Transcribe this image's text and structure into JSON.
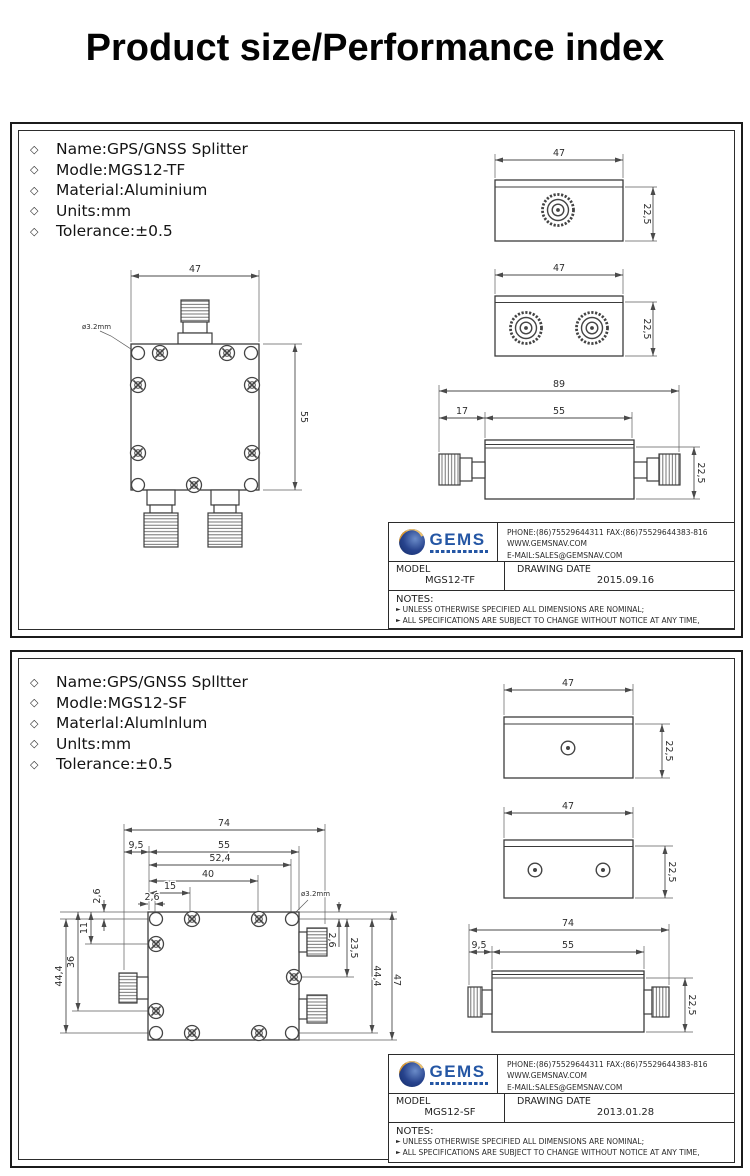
{
  "page_title": "Product size/Performance index",
  "panels": [
    {
      "specs": {
        "bullet": "◇",
        "items": [
          "Name:GPS/GNSS Splitter",
          "Modle:MGS12-TF",
          "Material:Aluminium",
          "Units:mm",
          "Tolerance:±0.5"
        ]
      },
      "front_view": {
        "width": "47",
        "height": "55",
        "hole": "ø3.2mm"
      },
      "top_view_1": {
        "width": "47",
        "height": "22,5"
      },
      "top_view_2": {
        "width": "47",
        "height": "22,5"
      },
      "side_view": {
        "total": "89",
        "left": "17",
        "body": "55",
        "height": "22,5"
      },
      "title_block": {
        "logo": "GEMS",
        "phone_fax": "PHONE:(86)75529644311  FAX:(86)75529644383-816",
        "website": "WWW.GEMSNAV.COM",
        "email": "E-MAIL:SALES@GEMSNAV.COM",
        "model_label": "MODEL",
        "model_value": "MGS12-TF",
        "date_label": "DRAWING DATE",
        "date_value": "2015.09.16",
        "notes_label": "NOTES:",
        "note_bullet": "►",
        "notes": [
          "UNLESS OTHERWISE SPECIFIED ALL DIMENSIONS ARE NOMINAL;",
          "ALL SPECIFICATIONS ARE SUBJECT TO CHANGE WITHOUT NOTICE AT ANY TIME,"
        ]
      }
    },
    {
      "specs": {
        "bullet": "◇",
        "items": [
          "Name:GPS/GNSS Splltter",
          "Modle:MGS12-SF",
          "Materlal:Alumlnlum",
          "Unlts:mm",
          "Tolerance:±0.5"
        ]
      },
      "front_view": {
        "top_dims": [
          "74",
          "9,5",
          "55",
          "52,4",
          "40",
          "15",
          "2,6"
        ],
        "left_dims": [
          "2,6",
          "11",
          "36",
          "44,4"
        ],
        "right_dims": [
          "2,6",
          "23,5",
          "44,4",
          "47"
        ],
        "hole": "ø3.2mm"
      },
      "top_view_1": {
        "width": "47",
        "height": "22,5"
      },
      "top_view_2": {
        "width": "47",
        "height": "22,5"
      },
      "side_view": {
        "total": "74",
        "left": "9,5",
        "body": "55",
        "height": "22,5"
      },
      "title_block": {
        "logo": "GEMS",
        "phone_fax": "PHONE:(86)75529644311  FAX:(86)75529644383-816",
        "website": "WWW.GEMSNAV.COM",
        "email": "E-MAIL:SALES@GEMSNAV.COM",
        "model_label": "MODEL",
        "model_value": "MGS12-SF",
        "date_label": "DRAWING DATE",
        "date_value": "2013.01.28",
        "notes_label": "NOTES:",
        "note_bullet": "►",
        "notes": [
          "UNLESS OTHERWISE SPECIFIED ALL DIMENSIONS ARE NOMINAL;",
          "ALL SPECIFICATIONS ARE SUBJECT TO CHANGE WITHOUT NOTICE AT ANY TIME,"
        ]
      }
    }
  ]
}
